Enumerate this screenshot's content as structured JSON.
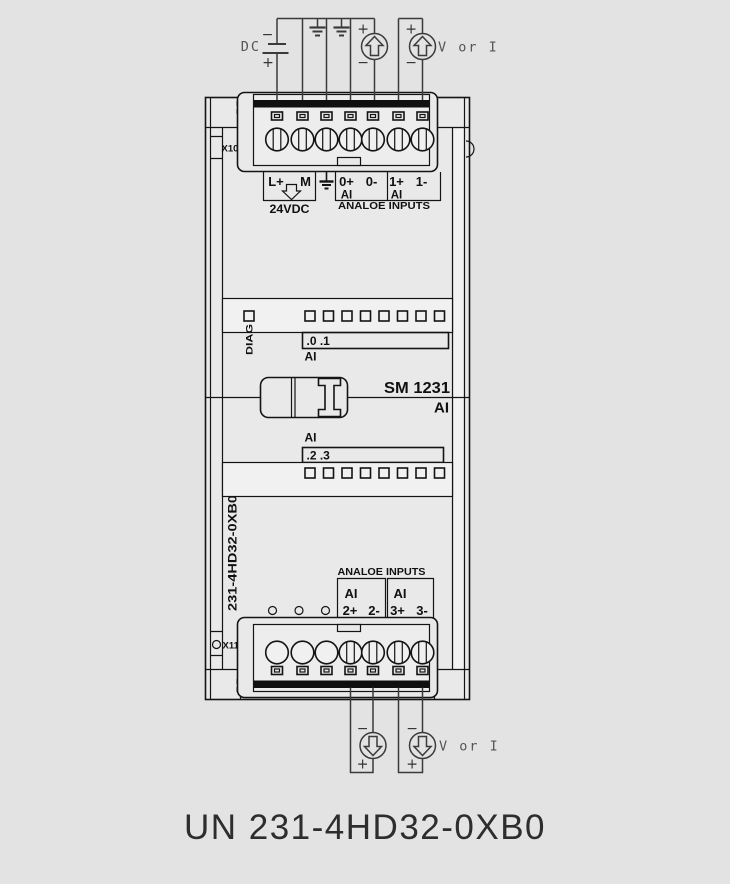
{
  "diagram_title": "UN 231-4HD32-0XB0",
  "colors": {
    "background": "#e3e3e3",
    "line": "#141414"
  },
  "module": {
    "model": "SM 1231",
    "model_type": "AI",
    "order_code_vertical": "231-4HD32-0XB0",
    "connector_top_label": "X10",
    "connector_bottom_label": "X11",
    "diag_led_label": "DIAG",
    "led_top": {
      "channels": ".0 .1",
      "group": "AI"
    },
    "led_bottom": {
      "channels": ".2 .3",
      "group": "AI"
    }
  },
  "top_wiring": {
    "dc_label": "DC",
    "dc_minus": "−",
    "dc_plus": "+",
    "source1_plus": "+",
    "source1_minus": "−",
    "source2_plus": "+",
    "source2_minus": "−",
    "source_type_label": "V or I"
  },
  "top_terminals": {
    "t1": "L+",
    "t2": "M",
    "t4": "0+",
    "t5": "0-",
    "t6": "1+",
    "t7": "1-",
    "supply_label": "24VDC",
    "ai_left": "AI",
    "ai_right": "AI",
    "group_label": "ANALOE INPUTS"
  },
  "bottom_terminals": {
    "group_label": "ANALOE INPUTS",
    "ai_left": "AI",
    "ai_right": "AI",
    "t4": "2+",
    "t5": "2-",
    "t6": "3+",
    "t7": "3-"
  },
  "bottom_wiring": {
    "source1_minus": "−",
    "source1_plus": "+",
    "source2_minus": "−",
    "source2_plus": "+",
    "source_type_label": "V or I"
  }
}
